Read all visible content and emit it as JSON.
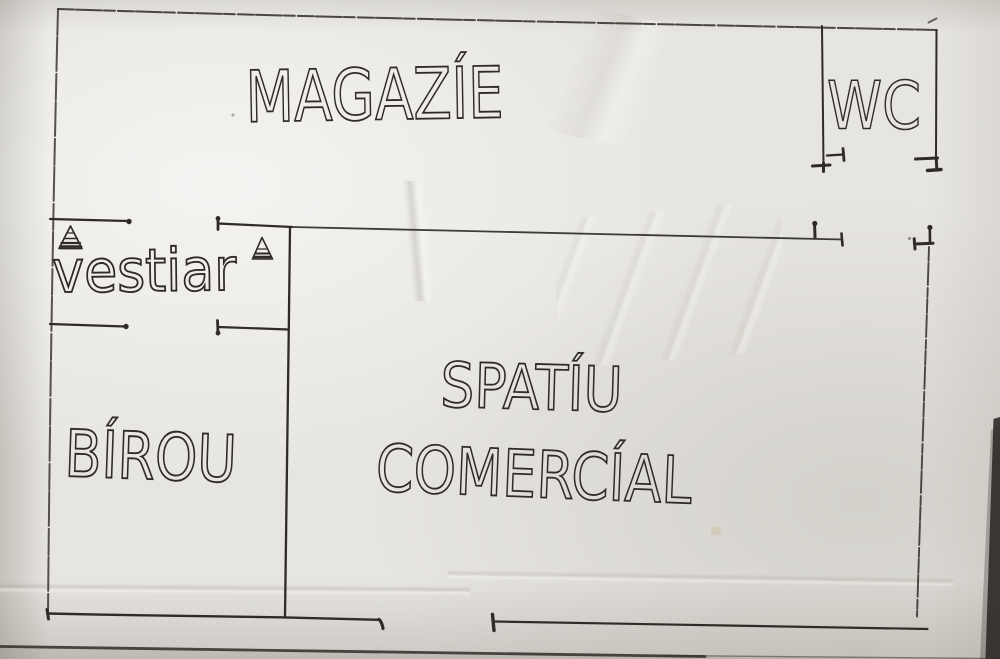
{
  "colors": {
    "paper": "#e7e5e0",
    "ink": "#2f2c27",
    "photo_edge": "#312e2a"
  },
  "rooms": {
    "magazie": {
      "label": "MAGAZÍE"
    },
    "wc": {
      "label": "WC"
    },
    "vestiar": {
      "label": "vestiar"
    },
    "birou": {
      "label": "BÍROU"
    },
    "spatiu_comercial": {
      "line1": "SPATÍU",
      "line2": "COMERCÍAL"
    }
  },
  "markers": {
    "door_marker_icons": [
      "hatched-triangle-icon",
      "hatched-triangle-icon"
    ]
  }
}
